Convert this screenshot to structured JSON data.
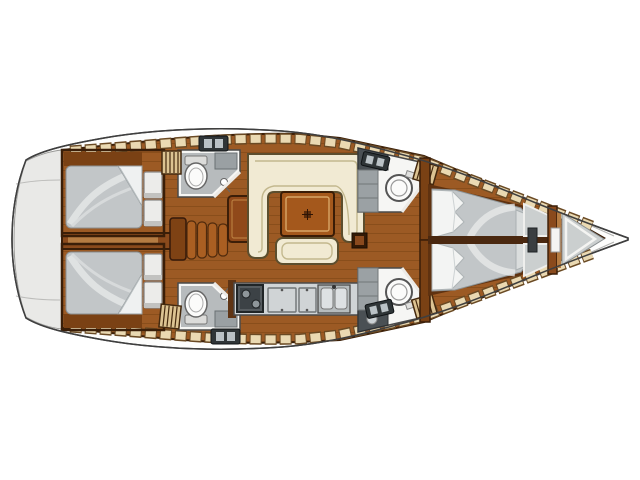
{
  "diagram": {
    "type": "boat-floor-plan",
    "view": "top-down",
    "orientation": {
      "bow": "right",
      "stern": "left"
    },
    "vessel_kind": "sailing-yacht-monohull",
    "parts": {
      "cabins": [
        {
          "id": "aft-cabin-port",
          "position": "aft-top",
          "furniture": [
            "double-berth",
            "storage-cabinets",
            "side-shelf"
          ]
        },
        {
          "id": "aft-cabin-starboard",
          "position": "aft-bottom",
          "furniture": [
            "double-berth",
            "storage-cabinets",
            "side-shelf"
          ]
        },
        {
          "id": "forward-cabin-port",
          "position": "forward-top",
          "furniture": [
            "double-berth",
            "pillows",
            "hull-shelf-band"
          ]
        },
        {
          "id": "forward-cabin-starboard",
          "position": "forward-bottom",
          "furniture": [
            "double-berth",
            "pillows",
            "hull-shelf-band"
          ]
        }
      ],
      "heads": [
        {
          "id": "head-amidships-port",
          "fixtures": [
            "toilet",
            "shower"
          ]
        },
        {
          "id": "head-amidships-starboard",
          "fixtures": [
            "toilet",
            "shower"
          ]
        },
        {
          "id": "head-forward-port",
          "fixtures": [
            "toilet",
            "sink",
            "lockers"
          ]
        },
        {
          "id": "head-forward-starboard",
          "fixtures": [
            "toilet",
            "sink",
            "lockers"
          ]
        }
      ],
      "salon": {
        "settee": "u-shaped",
        "table": true,
        "bench": true,
        "pedestal": true
      },
      "galley": {
        "stove_burners": 2,
        "sink_basins": 2,
        "counter_lids": 2
      },
      "companionway": {
        "steps": 4,
        "side_rail": true
      },
      "bow": {
        "vestibule_panels": 2,
        "bulkhead_door": true,
        "anchor-locker": true
      },
      "deck": {
        "hatches": 4,
        "slatted_lockers": 4,
        "stern_platform": true
      }
    }
  },
  "colors": {
    "hull_white": "#fdfdfc",
    "transom_gray": "#e9e9e7",
    "wood_floor": "#9c5a24",
    "wood_wall": "#8a4a1c",
    "wood_dark": "#5f3210",
    "shelf_tan": "#ead9b2",
    "slat_tan": "#dcc392",
    "bed_gray": "#c2c6c8",
    "pillow_white": "#f3f4f3",
    "settee_cream": "#f1ead3",
    "table_wood": "#a4581c",
    "head_wall": "#f6f6f4",
    "head_floor": "#b7bbbd",
    "fixture_white": "#fbfbfa",
    "counter_gray": "#d0d4d6",
    "stove_dark": "#565c60",
    "locker_gray": "#cbcfcf",
    "hatch_dark": "#2f3537",
    "hatch_light": "#bac2c6"
  }
}
